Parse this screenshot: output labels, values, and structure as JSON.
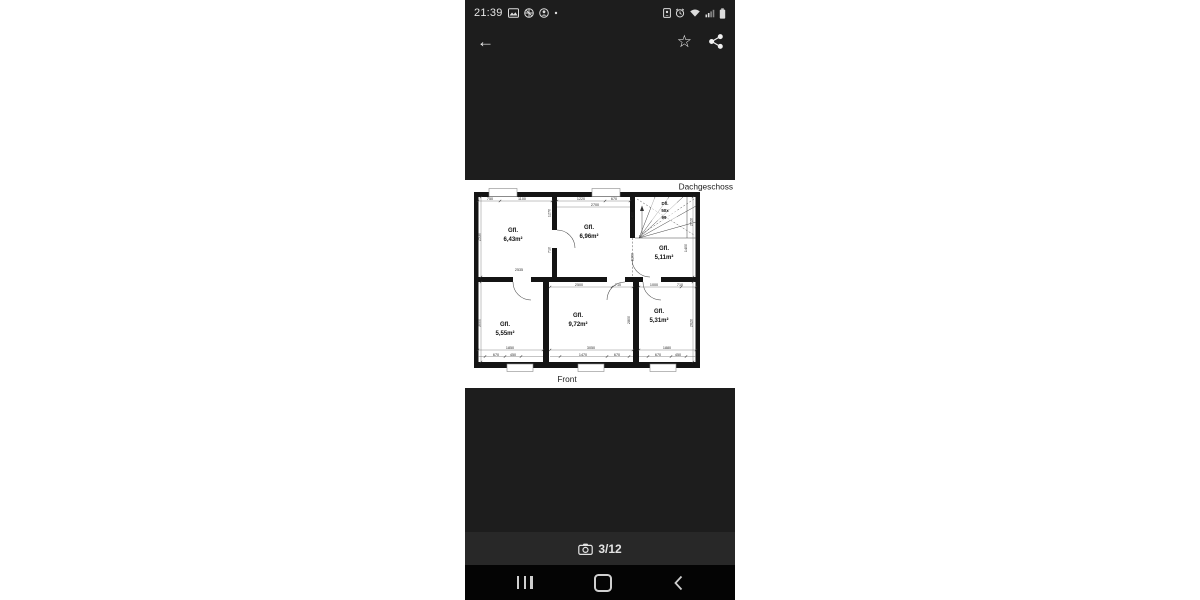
{
  "status_bar": {
    "time": "21:39"
  },
  "app_bar": {
    "back_glyph": "←",
    "star_glyph": "☆"
  },
  "viewer": {
    "counter": "3/12"
  },
  "plan": {
    "floor_title": "Dachgeschoss",
    "front_label": "Front",
    "rooms": [
      {
        "label": "Gfl.",
        "area": "6,43m²"
      },
      {
        "label": "Gfl.",
        "area": "6,96m²"
      },
      {
        "label": "Gfl.",
        "area": "5,11m²"
      },
      {
        "label": "Gfl.",
        "area": "5,55m²"
      },
      {
        "label": "Gfl.",
        "area": "9,72m²"
      },
      {
        "label": "Gfl.",
        "area": "5,31m²"
      }
    ],
    "stair": {
      "l1": "Dfl.",
      "l2": "50x",
      "l3": "99"
    },
    "dims": [
      "750",
      "1100",
      "2530",
      "2535",
      "1270",
      "710",
      "1220",
      "670",
      "2700",
      "1400",
      "1260",
      "2720",
      "1400",
      "2500",
      "710",
      "1000",
      "710",
      "3000",
      "2800",
      "2620",
      "1850",
      "3050",
      "1880",
      "670",
      "450",
      "1470",
      "670",
      "670",
      "450"
    ]
  }
}
